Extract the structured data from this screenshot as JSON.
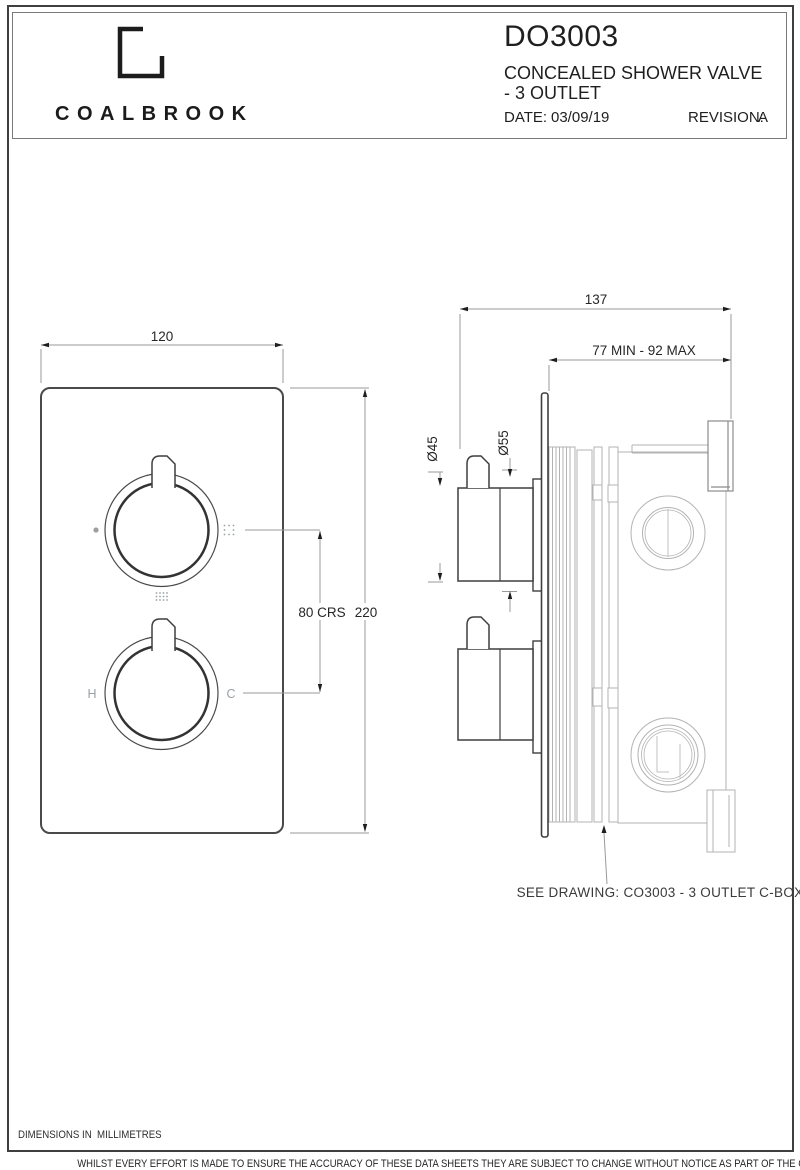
{
  "header": {
    "logo_text": "COALBROOK",
    "product_code": "DO3003",
    "product_name_line1": "CONCEALED SHOWER VALVE",
    "product_name_line2": "- 3 OUTLET",
    "date_label": "DATE:",
    "date_value": "03/09/19",
    "revision_label": "REVISION:",
    "revision_value": "A"
  },
  "drawing": {
    "front_view": {
      "width_dim": "120",
      "height_dim": "220",
      "centres_dim": "80 CRS",
      "hot_label": "H",
      "cold_label": "C"
    },
    "side_view": {
      "depth_dim": "137",
      "projection_dim": "77 MIN - 92 MAX",
      "knob_diameter_dim": "Ø45",
      "flange_diameter_dim": "Ø55",
      "note": "SEE DRAWING: CO3003 - 3 OUTLET C-BOX"
    }
  },
  "footer": {
    "units_note": "DIMENSIONS IN  MILLIMETRES",
    "disclaimer": "WHILST EVERY EFFORT IS MADE TO ENSURE THE ACCURACY OF THESE DATA SHEETS THEY ARE SUBJECT TO CHANGE WITHOUT NOTICE AS PART OF THE COMPANY'S PRODUCT DEVELOPMENT PROCESS"
  },
  "colors": {
    "line_dark": "#3f3f3f",
    "line_light": "#b3b3b3",
    "dim_line": "#9a9a9a",
    "annotation_gray": "#9aa0a4",
    "text": "#222222"
  }
}
